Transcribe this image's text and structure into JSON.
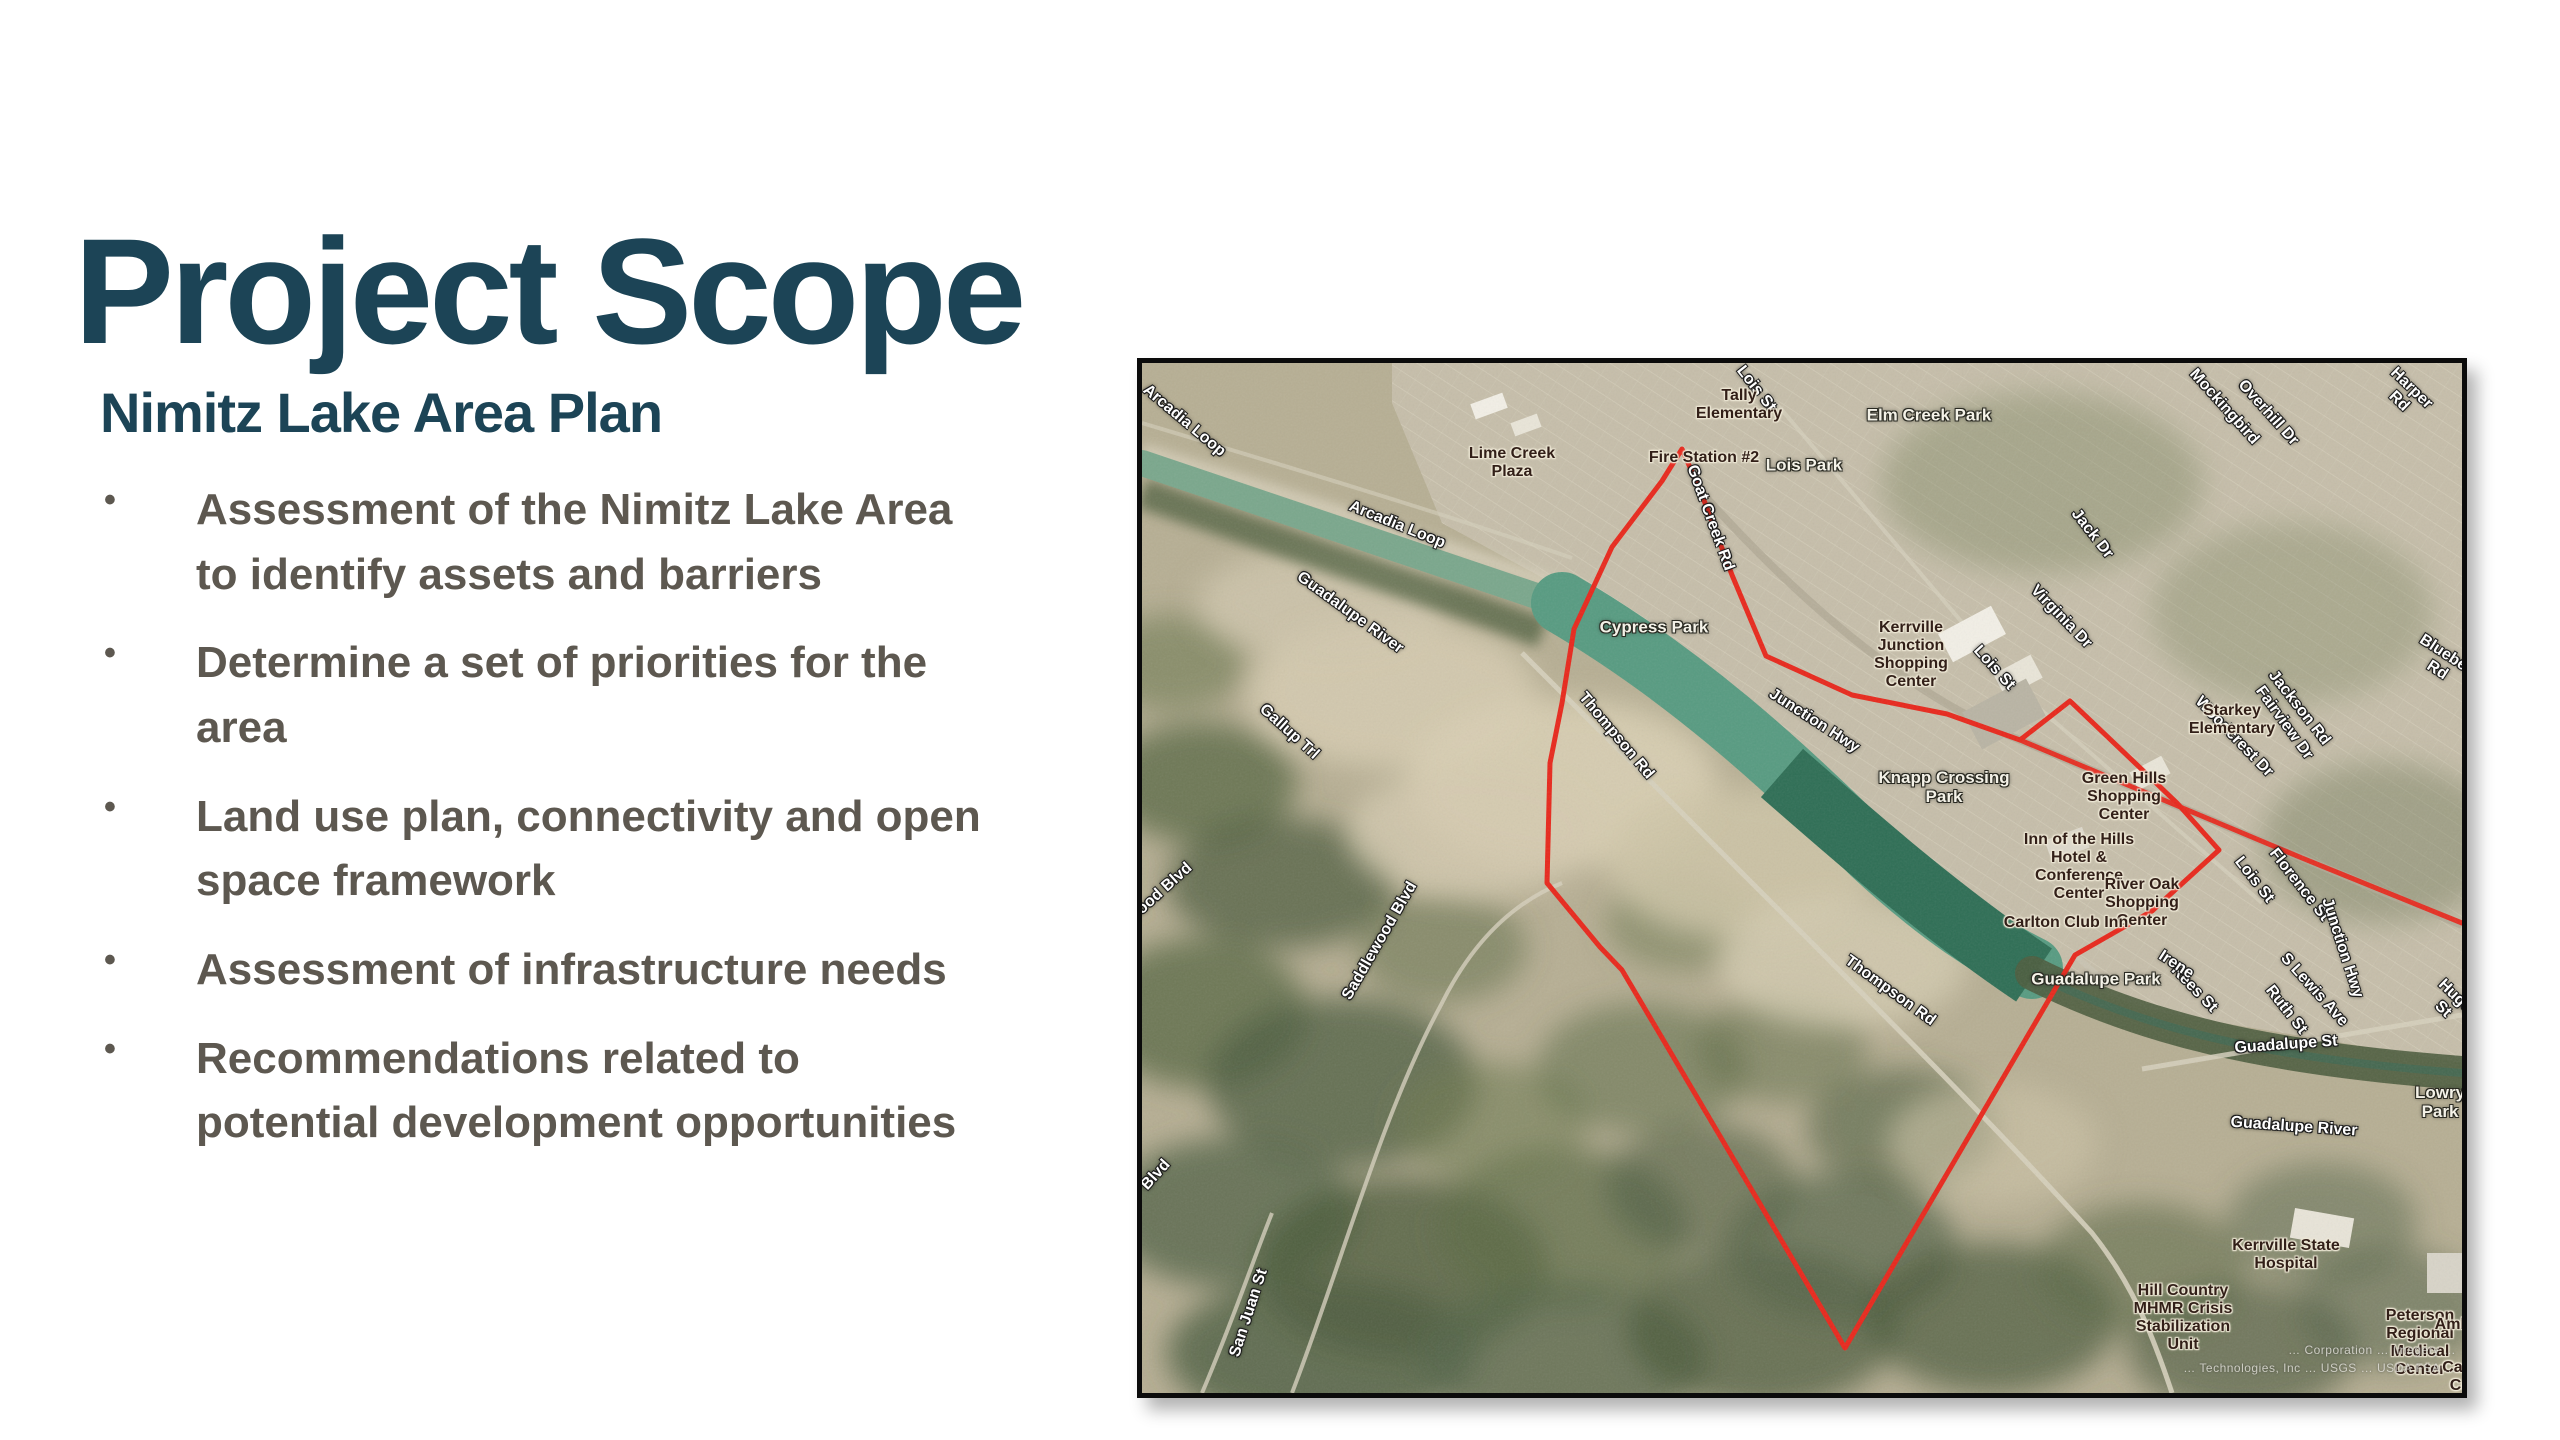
{
  "slide": {
    "title": "Project Scope",
    "subtitle": "Nimitz Lake Area Plan",
    "bullet_char": "•",
    "bullets": [
      "Assessment of the Nimitz Lake Area\nto identify assets and barriers",
      "Determine a set of priorities for the\narea",
      "Land use plan, connectivity and open\nspace framework",
      "Assessment of infrastructure needs",
      "Recommendations related to\npotential development opportunities"
    ]
  },
  "colors": {
    "heading_teal": "#1c4456",
    "bullet_gray": "#5d5850",
    "boundary_red": "#e8281c",
    "water_teal": "#579b81",
    "water_dark": "#2e6e55",
    "terrain_tan": "#bdb49a",
    "map_border": "#0b0b0b"
  },
  "map": {
    "attribution_line1": "… Corporation … Imagery …",
    "attribution_line2": "… Technologies, Inc … USGS … USDA FSA …",
    "boundary_points": [
      [
        540,
        86
      ],
      [
        560,
        132
      ],
      [
        590,
        212
      ],
      [
        624,
        293
      ],
      [
        710,
        332
      ],
      [
        805,
        351
      ],
      [
        878,
        377
      ],
      [
        928,
        338
      ],
      [
        1035,
        440
      ],
      [
        1077,
        487
      ],
      [
        1010,
        548
      ],
      [
        933,
        592
      ],
      [
        703,
        985
      ],
      [
        480,
        607
      ],
      [
        458,
        584
      ],
      [
        405,
        520
      ],
      [
        408,
        400
      ],
      [
        420,
        340
      ],
      [
        432,
        266
      ],
      [
        470,
        184
      ],
      [
        520,
        118
      ]
    ],
    "junction_ext_points": [
      [
        878,
        377
      ],
      [
        1000,
        428
      ],
      [
        1160,
        495
      ],
      [
        1320,
        560
      ]
    ],
    "river": {
      "upper": {
        "d": "M0,100 C 150,150 300,200 430,245"
      },
      "lake": {
        "d": "M420,240 C 540,310 640,400 730,490 C 800,555 850,585 890,605"
      },
      "lake_dark": {
        "d": "M640,410 C 720,480 800,550 892,612"
      },
      "corridor": {
        "d": "M890,610 C 1000,665 1120,695 1320,710"
      }
    },
    "labels": [
      {
        "text": "Arcadia Loop",
        "x": 42,
        "y": 58,
        "rot": 40,
        "cls": "street"
      },
      {
        "text": "Arcadia Loop",
        "x": 255,
        "y": 162,
        "rot": 22,
        "cls": "street"
      },
      {
        "text": "Lois St",
        "x": 614,
        "y": 26,
        "rot": 52,
        "cls": "street"
      },
      {
        "text": "Goat Creek Rd",
        "x": 568,
        "y": 155,
        "rot": 70,
        "cls": "street"
      },
      {
        "text": "Guadalupe River",
        "x": 208,
        "y": 250,
        "rot": 36,
        "cls": "street"
      },
      {
        "text": "Junction Hwy",
        "x": 672,
        "y": 358,
        "rot": 33,
        "cls": "street"
      },
      {
        "text": "Thompson Rd",
        "x": 474,
        "y": 373,
        "rot": 50,
        "cls": "street"
      },
      {
        "text": "Thompson Rd",
        "x": 748,
        "y": 628,
        "rot": 36,
        "cls": "street"
      },
      {
        "text": "Rees St",
        "x": 1052,
        "y": 626,
        "rot": 46,
        "cls": "street"
      },
      {
        "text": "S Lewis Ave",
        "x": 1172,
        "y": 627,
        "rot": 48,
        "cls": "street"
      },
      {
        "text": "Hugo St",
        "x": 1307,
        "y": 640,
        "rot": 44,
        "cls": "street"
      },
      {
        "text": "Guadalupe St",
        "x": 1144,
        "y": 682,
        "rot": -4,
        "cls": "street"
      },
      {
        "text": "Guadalupe River",
        "x": 1152,
        "y": 764,
        "rot": 4,
        "cls": "street"
      },
      {
        "text": "Jackson Rd",
        "x": 1157,
        "y": 345,
        "rot": 52,
        "cls": "street"
      },
      {
        "text": "Bluebell Rd",
        "x": 1300,
        "y": 300,
        "rot": 33,
        "cls": "street"
      },
      {
        "text": "Virginia Dr",
        "x": 919,
        "y": 254,
        "rot": 46,
        "cls": "street"
      },
      {
        "text": "Jack Dr",
        "x": 950,
        "y": 171,
        "rot": 52,
        "cls": "street"
      },
      {
        "text": "Lois St",
        "x": 852,
        "y": 305,
        "rot": 48,
        "cls": "street"
      },
      {
        "text": "Mockingbird",
        "x": 1082,
        "y": 44,
        "rot": 48,
        "cls": "street"
      },
      {
        "text": "Overhill Dr",
        "x": 1126,
        "y": 50,
        "rot": 48,
        "cls": "street"
      },
      {
        "text": "Harper Rd",
        "x": 1263,
        "y": 32,
        "rot": 44,
        "cls": "street"
      },
      {
        "text": "Woodcrest Dr",
        "x": 1092,
        "y": 374,
        "rot": 46,
        "cls": "street"
      },
      {
        "text": "Fairview Dr",
        "x": 1142,
        "y": 360,
        "rot": 54,
        "cls": "street"
      },
      {
        "text": "Lois St",
        "x": 1112,
        "y": 517,
        "rot": 52,
        "cls": "street"
      },
      {
        "text": "Florence St",
        "x": 1157,
        "y": 522,
        "rot": 52,
        "cls": "street"
      },
      {
        "text": "Irene",
        "x": 1034,
        "y": 602,
        "rot": 33,
        "cls": "street"
      },
      {
        "text": "Ruth St",
        "x": 1144,
        "y": 647,
        "rot": 52,
        "cls": "street"
      },
      {
        "text": "Junction Hwy",
        "x": 1200,
        "y": 585,
        "rot": 72,
        "cls": "street"
      },
      {
        "text": "Gallup Trl",
        "x": 147,
        "y": 369,
        "rot": 42,
        "cls": "street"
      },
      {
        "text": "Saddlewood Blvd",
        "x": 238,
        "y": 578,
        "rot": -60,
        "cls": "street"
      },
      {
        "text": "wood Blvd",
        "x": 18,
        "y": 530,
        "rot": -42,
        "cls": "street"
      },
      {
        "text": "Blvd",
        "x": 14,
        "y": 812,
        "rot": -48,
        "cls": "street"
      },
      {
        "text": "San Juan St",
        "x": 107,
        "y": 950,
        "rot": -72,
        "cls": "street"
      },
      {
        "text": "Lois Park",
        "x": 662,
        "y": 102,
        "rot": 0,
        "cls": "park"
      },
      {
        "text": "Elm Creek Park",
        "x": 787,
        "y": 52,
        "rot": 0,
        "cls": "park"
      },
      {
        "text": "Cypress Park",
        "x": 512,
        "y": 264,
        "rot": 0,
        "cls": "park"
      },
      {
        "text": "Knapp Crossing\nPark",
        "x": 802,
        "y": 424,
        "rot": 0,
        "cls": "park"
      },
      {
        "text": "Guadalupe Park",
        "x": 954,
        "y": 616,
        "rot": 0,
        "cls": "park"
      },
      {
        "text": "Lowry Park",
        "x": 1298,
        "y": 739,
        "rot": 0,
        "cls": "park"
      },
      {
        "text": "Lime Creek\nPlaza",
        "x": 370,
        "y": 100,
        "rot": 0,
        "cls": "poi"
      },
      {
        "text": "Tally\nElementary",
        "x": 597,
        "y": 42,
        "rot": 0,
        "cls": "poi"
      },
      {
        "text": "Fire Station #2",
        "x": 562,
        "y": 95,
        "rot": 0,
        "cls": "poi"
      },
      {
        "text": "Kerrville\nJunction\nShopping\nCenter",
        "x": 769,
        "y": 292,
        "rot": 0,
        "cls": "poi"
      },
      {
        "text": "Green Hills\nShopping\nCenter",
        "x": 982,
        "y": 434,
        "rot": 0,
        "cls": "poi"
      },
      {
        "text": "Inn of the Hills\nHotel &\nConference\nCenter",
        "x": 937,
        "y": 504,
        "rot": 0,
        "cls": "poi"
      },
      {
        "text": "River Oak\nShopping\nCenter",
        "x": 1000,
        "y": 540,
        "rot": 0,
        "cls": "poi"
      },
      {
        "text": "Carlton Club Inn",
        "x": 924,
        "y": 560,
        "rot": 0,
        "cls": "poi"
      },
      {
        "text": "Starkey\nElementary",
        "x": 1090,
        "y": 357,
        "rot": 0,
        "cls": "poi"
      },
      {
        "text": "Kerrville State\nHospital",
        "x": 1144,
        "y": 892,
        "rot": 0,
        "cls": "poi"
      },
      {
        "text": "Hill Country\nMHMR Crisis\nStabilization\nUnit",
        "x": 1041,
        "y": 955,
        "rot": 0,
        "cls": "poi"
      },
      {
        "text": "Peterson\nRegional\nMedical Center",
        "x": 1278,
        "y": 980,
        "rot": 0,
        "cls": "poi"
      },
      {
        "text": "Ambula",
        "x": 1322,
        "y": 962,
        "rot": 0,
        "cls": "poi"
      },
      {
        "text": "Care Ce",
        "x": 1318,
        "y": 1014,
        "rot": 0,
        "cls": "poi"
      }
    ]
  }
}
